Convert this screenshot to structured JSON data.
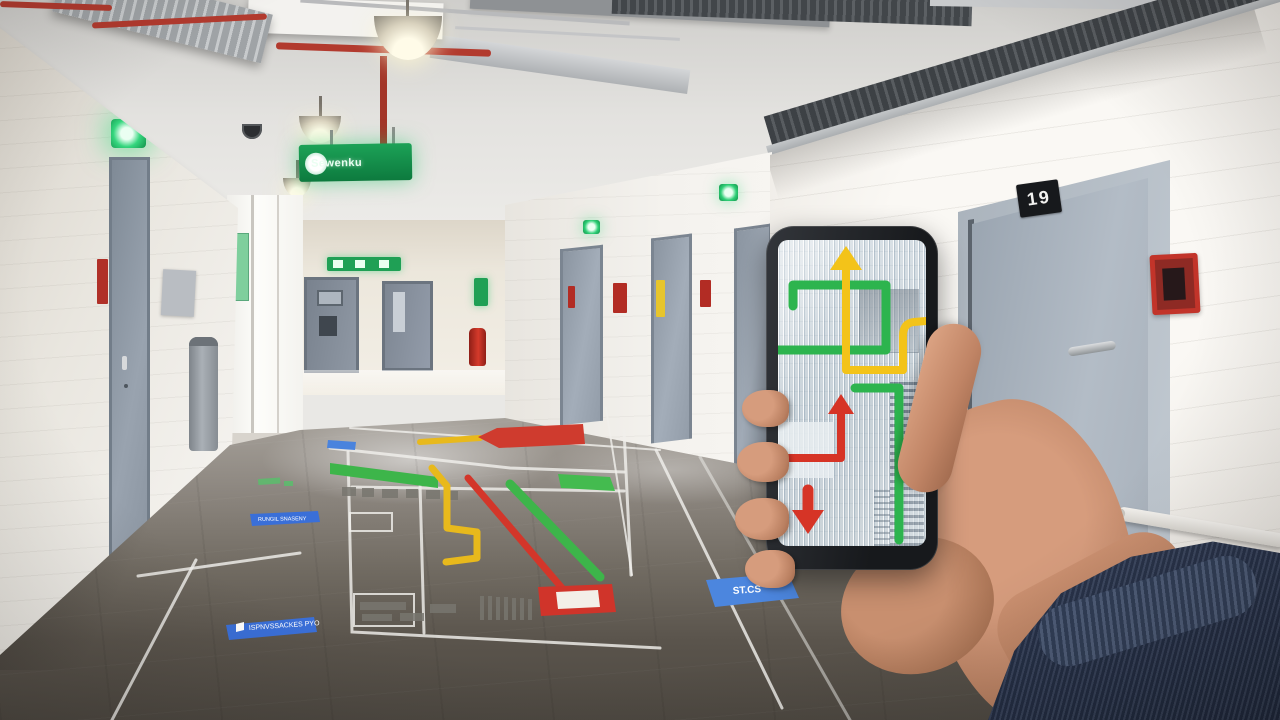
{
  "scene": {
    "description": "Corridor with painted evacuation floor plan; a hand holds a smartphone showing indoor navigation routes"
  },
  "right_wall": {
    "door_plate_number": "19"
  },
  "hanging_sign": {
    "text": "Sewenku",
    "icon": "white-circle",
    "color": "#17934c"
  },
  "floor_labels": {
    "small_left": "RUNGIL SNASENY",
    "large_left": "ISPNVSSACKES PYO",
    "right": "ST.CS",
    "label_color": "#3a6fd8"
  },
  "phone_screen": {
    "routes": [
      {
        "name": "green-route",
        "color": "#2db44e"
      },
      {
        "name": "yellow-route-up-arrow",
        "color": "#f3c319"
      },
      {
        "name": "red-route-up-and-down-arrows",
        "color": "#d63426"
      }
    ]
  },
  "floor_plan": {
    "route_colors": {
      "green": "#3db54a",
      "yellow": "#e8b91c",
      "red": "#d3362a"
    },
    "line_color": "#f0efec"
  },
  "colors": {
    "exit_green": "#12a455",
    "alarm_red": "#c2342a",
    "sleeve_navy": "#2c3850",
    "floor_dark": "#57524b",
    "door_gray": "#9aa5b1"
  }
}
